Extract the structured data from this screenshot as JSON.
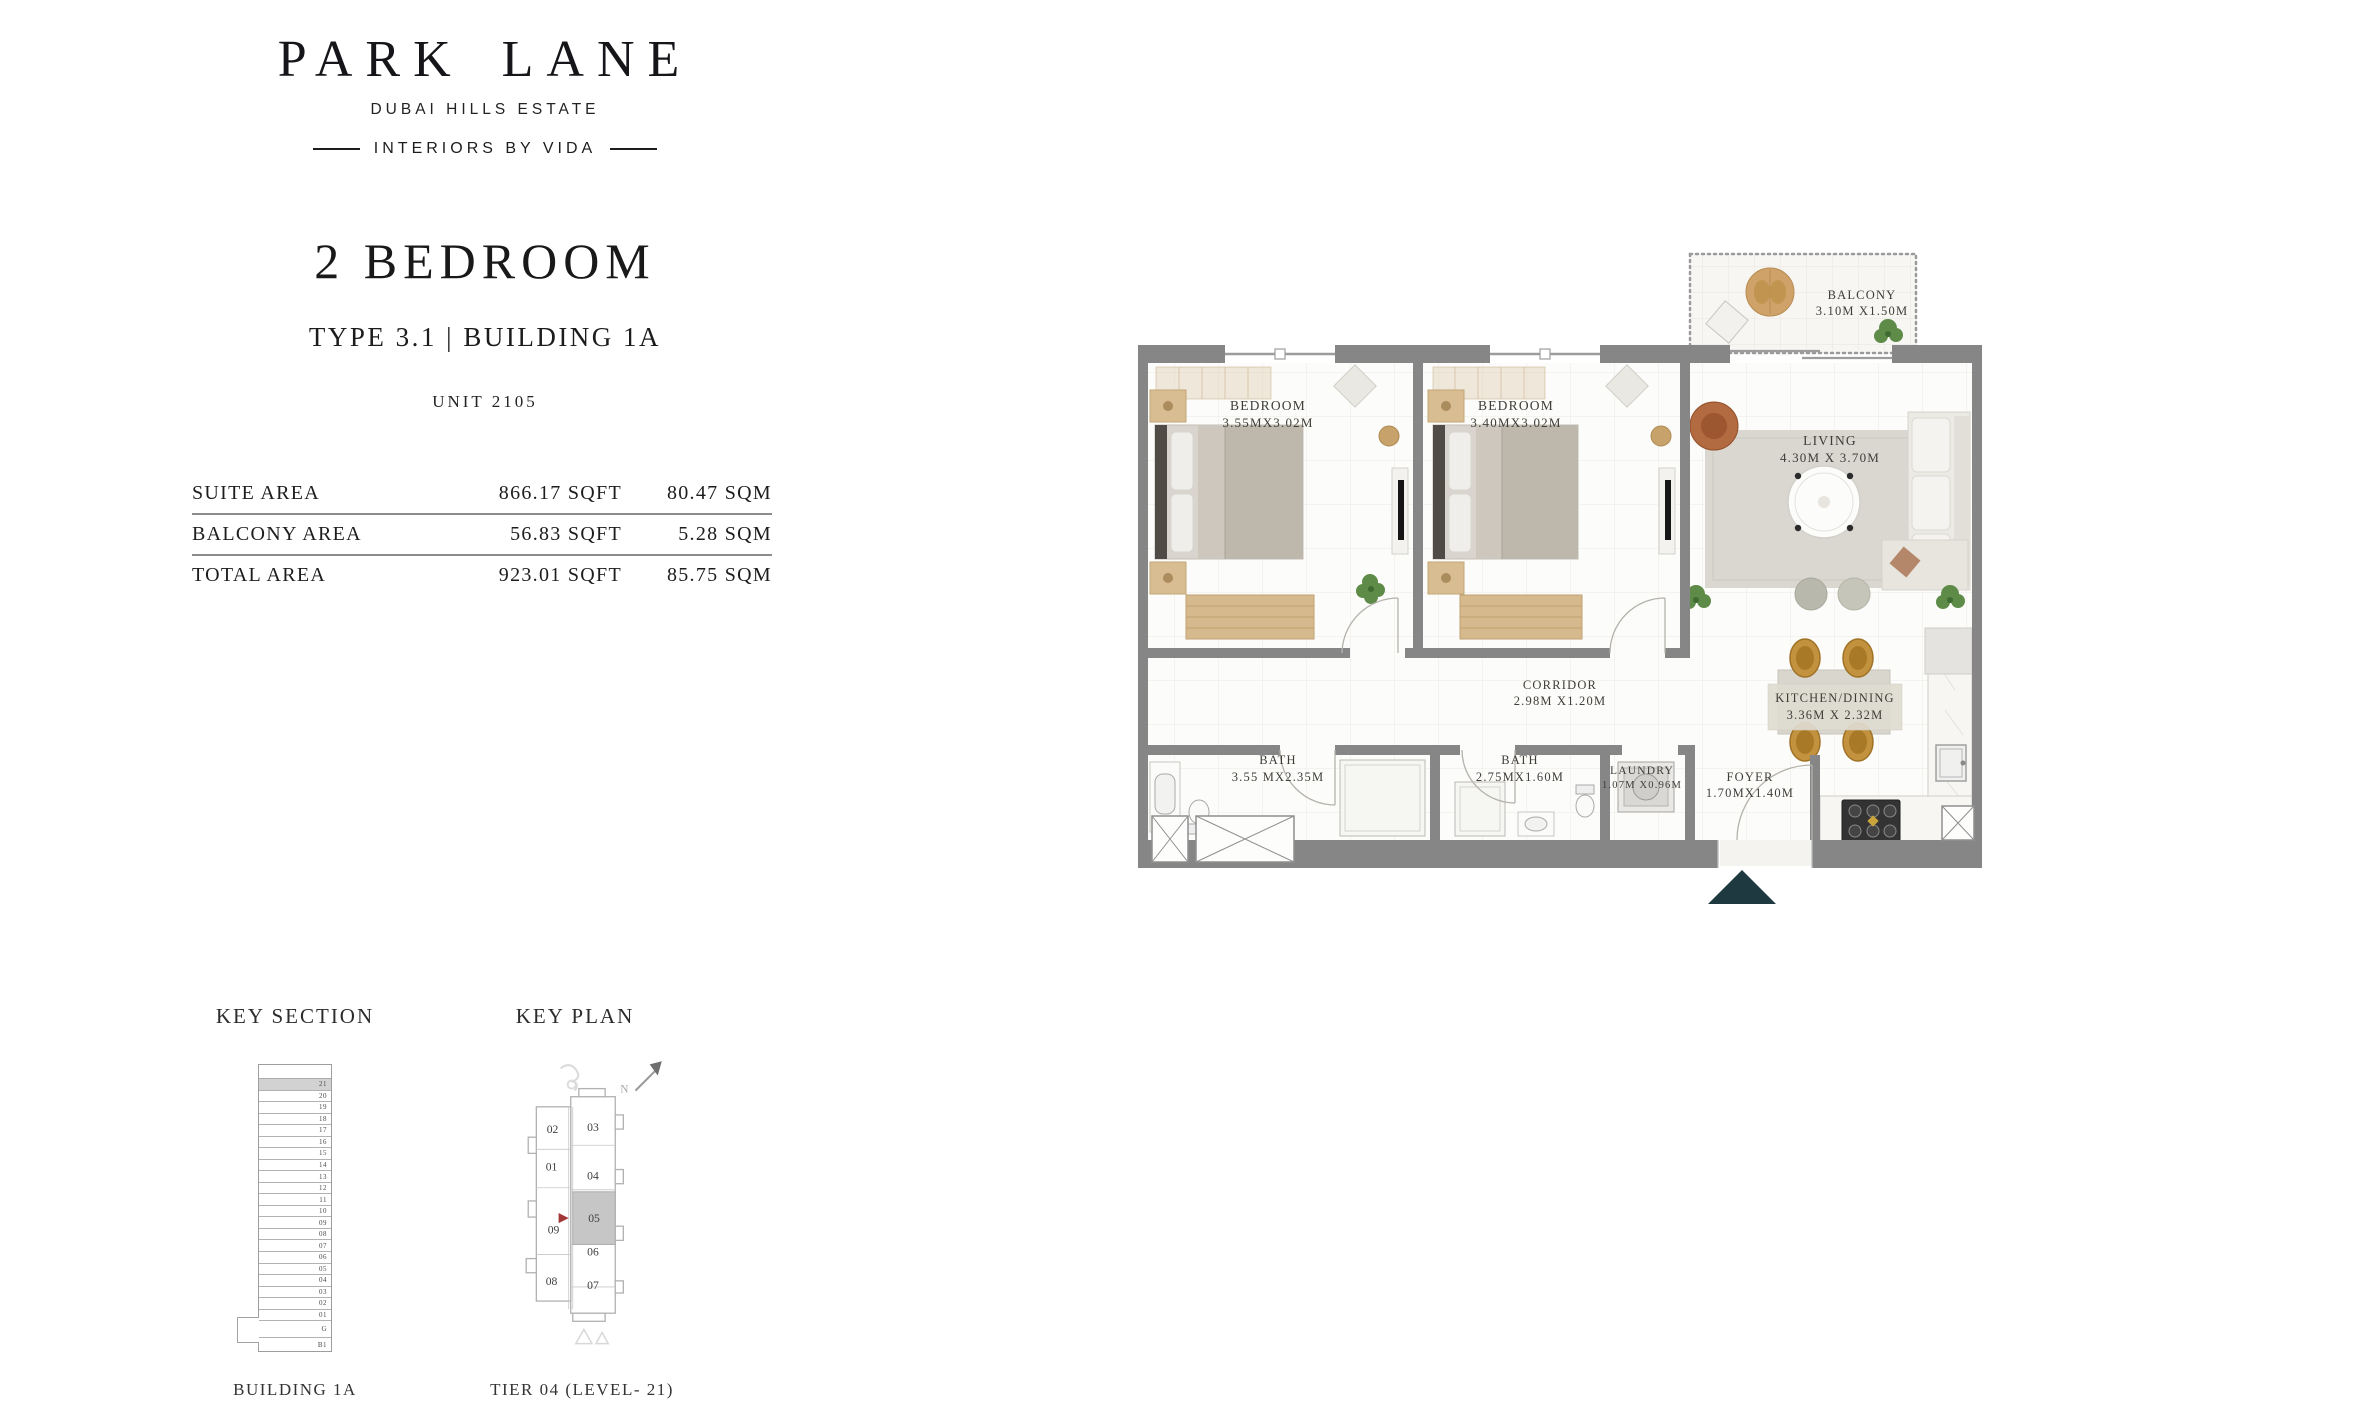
{
  "brand": {
    "logo": "PARK LANE",
    "location": "DUBAI HILLS ESTATE",
    "tagline": "INTERIORS BY VIDA"
  },
  "unit": {
    "title": "2 BEDROOM",
    "type_line": "TYPE 3.1 | BUILDING 1A",
    "unit_line": "UNIT 2105"
  },
  "area_table": {
    "rows": [
      {
        "label": "SUITE AREA",
        "sqft": "866.17 SQFT",
        "sqm": "80.47 SQM"
      },
      {
        "label": "BALCONY AREA",
        "sqft": "56.83 SQFT",
        "sqm": "5.28 SQM"
      },
      {
        "label": "TOTAL AREA",
        "sqft": "923.01 SQFT",
        "sqm": "85.75 SQM"
      }
    ]
  },
  "floorplan": {
    "rooms": [
      {
        "name": "BALCONY",
        "dims": "3.10M X1.50M"
      },
      {
        "name": "BEDROOM",
        "dims": "3.55MX3.02M"
      },
      {
        "name": "BEDROOM",
        "dims": "3.40MX3.02M"
      },
      {
        "name": "LIVING",
        "dims": "4.30M X 3.70M"
      },
      {
        "name": "CORRIDOR",
        "dims": "2.98M X1.20M"
      },
      {
        "name": "KITCHEN/DINING",
        "dims": "3.36M X 2.32M"
      },
      {
        "name": "BATH",
        "dims": "3.55 MX2.35M"
      },
      {
        "name": "BATH",
        "dims": "2.75MX1.60M"
      },
      {
        "name": "LAUNDRY",
        "dims": "1.07M X0.96M"
      },
      {
        "name": "FOYER",
        "dims": "1.70MX1.40M"
      }
    ]
  },
  "key_section": {
    "heading": "KEY SECTION",
    "caption": "BUILDING 1A",
    "floors": [
      "21",
      "20",
      "19",
      "18",
      "17",
      "16",
      "15",
      "14",
      "13",
      "12",
      "11",
      "10",
      "09",
      "08",
      "07",
      "06",
      "05",
      "04",
      "03",
      "02",
      "01",
      "G",
      "B1"
    ],
    "highlighted_floor": "21"
  },
  "key_plan": {
    "heading": "KEY PLAN",
    "caption": "TIER 04 (LEVEL- 21)",
    "north_label": "N",
    "units": [
      "02",
      "03",
      "01",
      "04",
      "05",
      "09",
      "06",
      "08",
      "07"
    ],
    "highlighted_unit": "05"
  },
  "colors": {
    "wall": "#868686",
    "wood": "#c9a87c",
    "plant": "#5e8b47",
    "entry_arrow": "#1e3a40",
    "keyplan_highlight": "#c6c6c6",
    "keyplan_pointer": "#a13636"
  }
}
